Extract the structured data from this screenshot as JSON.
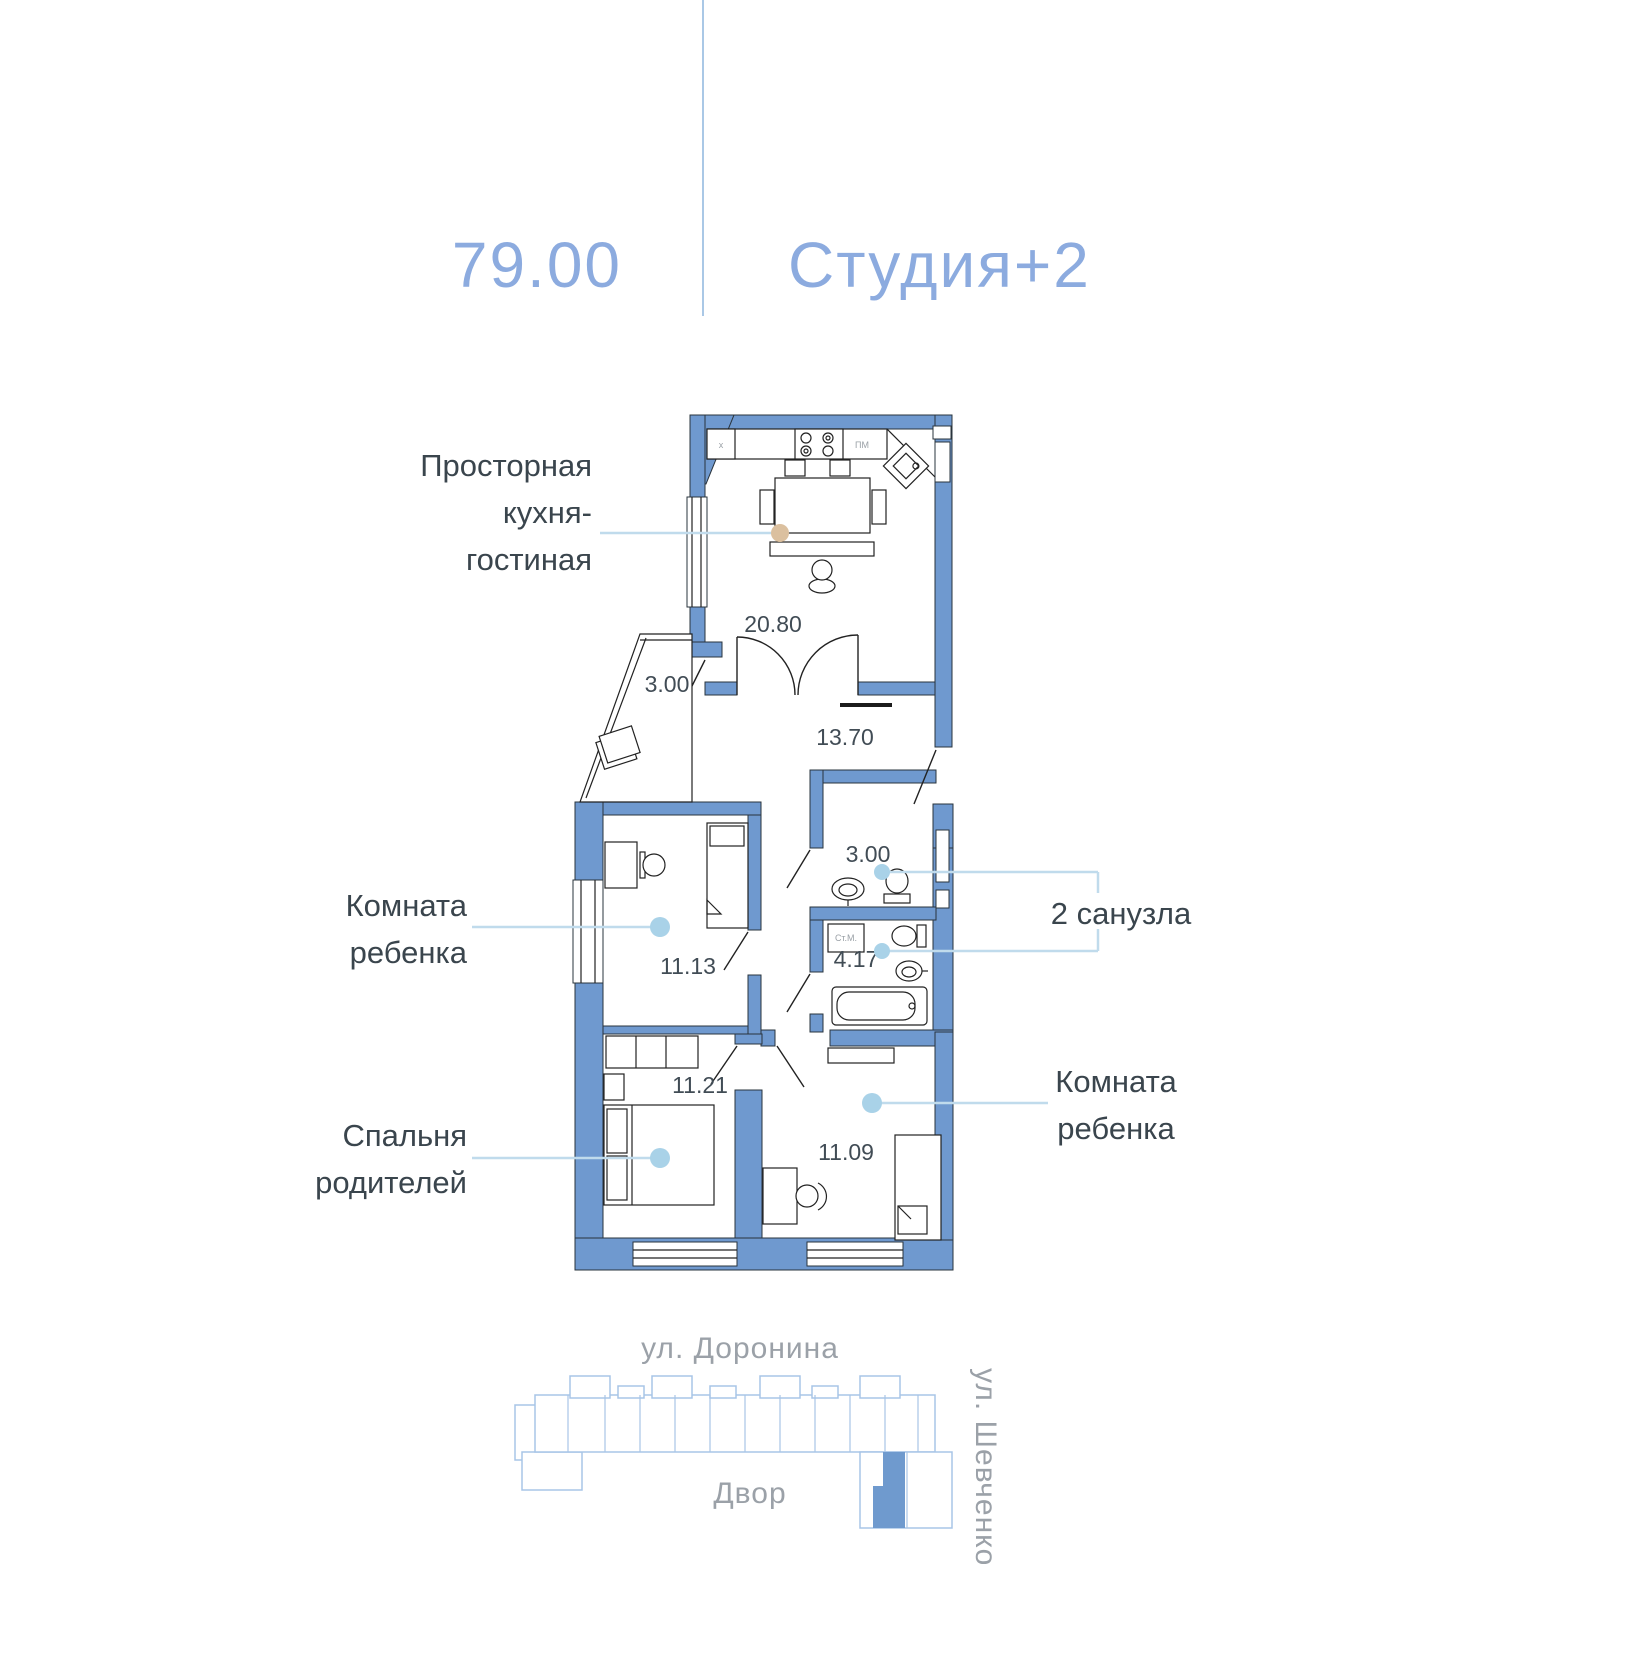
{
  "header": {
    "area": "79.00",
    "type": "Студия+2"
  },
  "labels": {
    "kitchen": {
      "l1": "Просторная",
      "l2": "кухня-",
      "l3": "гостиная"
    },
    "child1": {
      "l1": "Комната",
      "l2": "ребенка"
    },
    "bedroom": {
      "l1": "Спальня",
      "l2": "родителей"
    },
    "child2": {
      "l1": "Комната",
      "l2": "ребенка"
    },
    "bathrooms": "2 санузла"
  },
  "areas": {
    "kitchen": "20.80",
    "balcony": "3.00",
    "hallway": "13.70",
    "wc": "3.00",
    "bath": "4.17",
    "child1": "11.13",
    "bedroom": "11.21",
    "child2": "11.09"
  },
  "appliances": {
    "dishwasher": "ПМ",
    "fridge": "x",
    "washer": "Ст.М."
  },
  "site": {
    "street_top": "ул. Доронина",
    "street_right": "ул. Шевченко",
    "courtyard": "Двор"
  },
  "colors": {
    "wall": "#6f99cf",
    "header_text": "#8cabdf",
    "leader_line": "#c0dbec",
    "kitchen_dot": "#dbc09f",
    "room_dot": "#a9d2e8",
    "label_text": "#3a454d",
    "street_text": "#9ba1a8",
    "site_outline": "#a8c5e7"
  }
}
